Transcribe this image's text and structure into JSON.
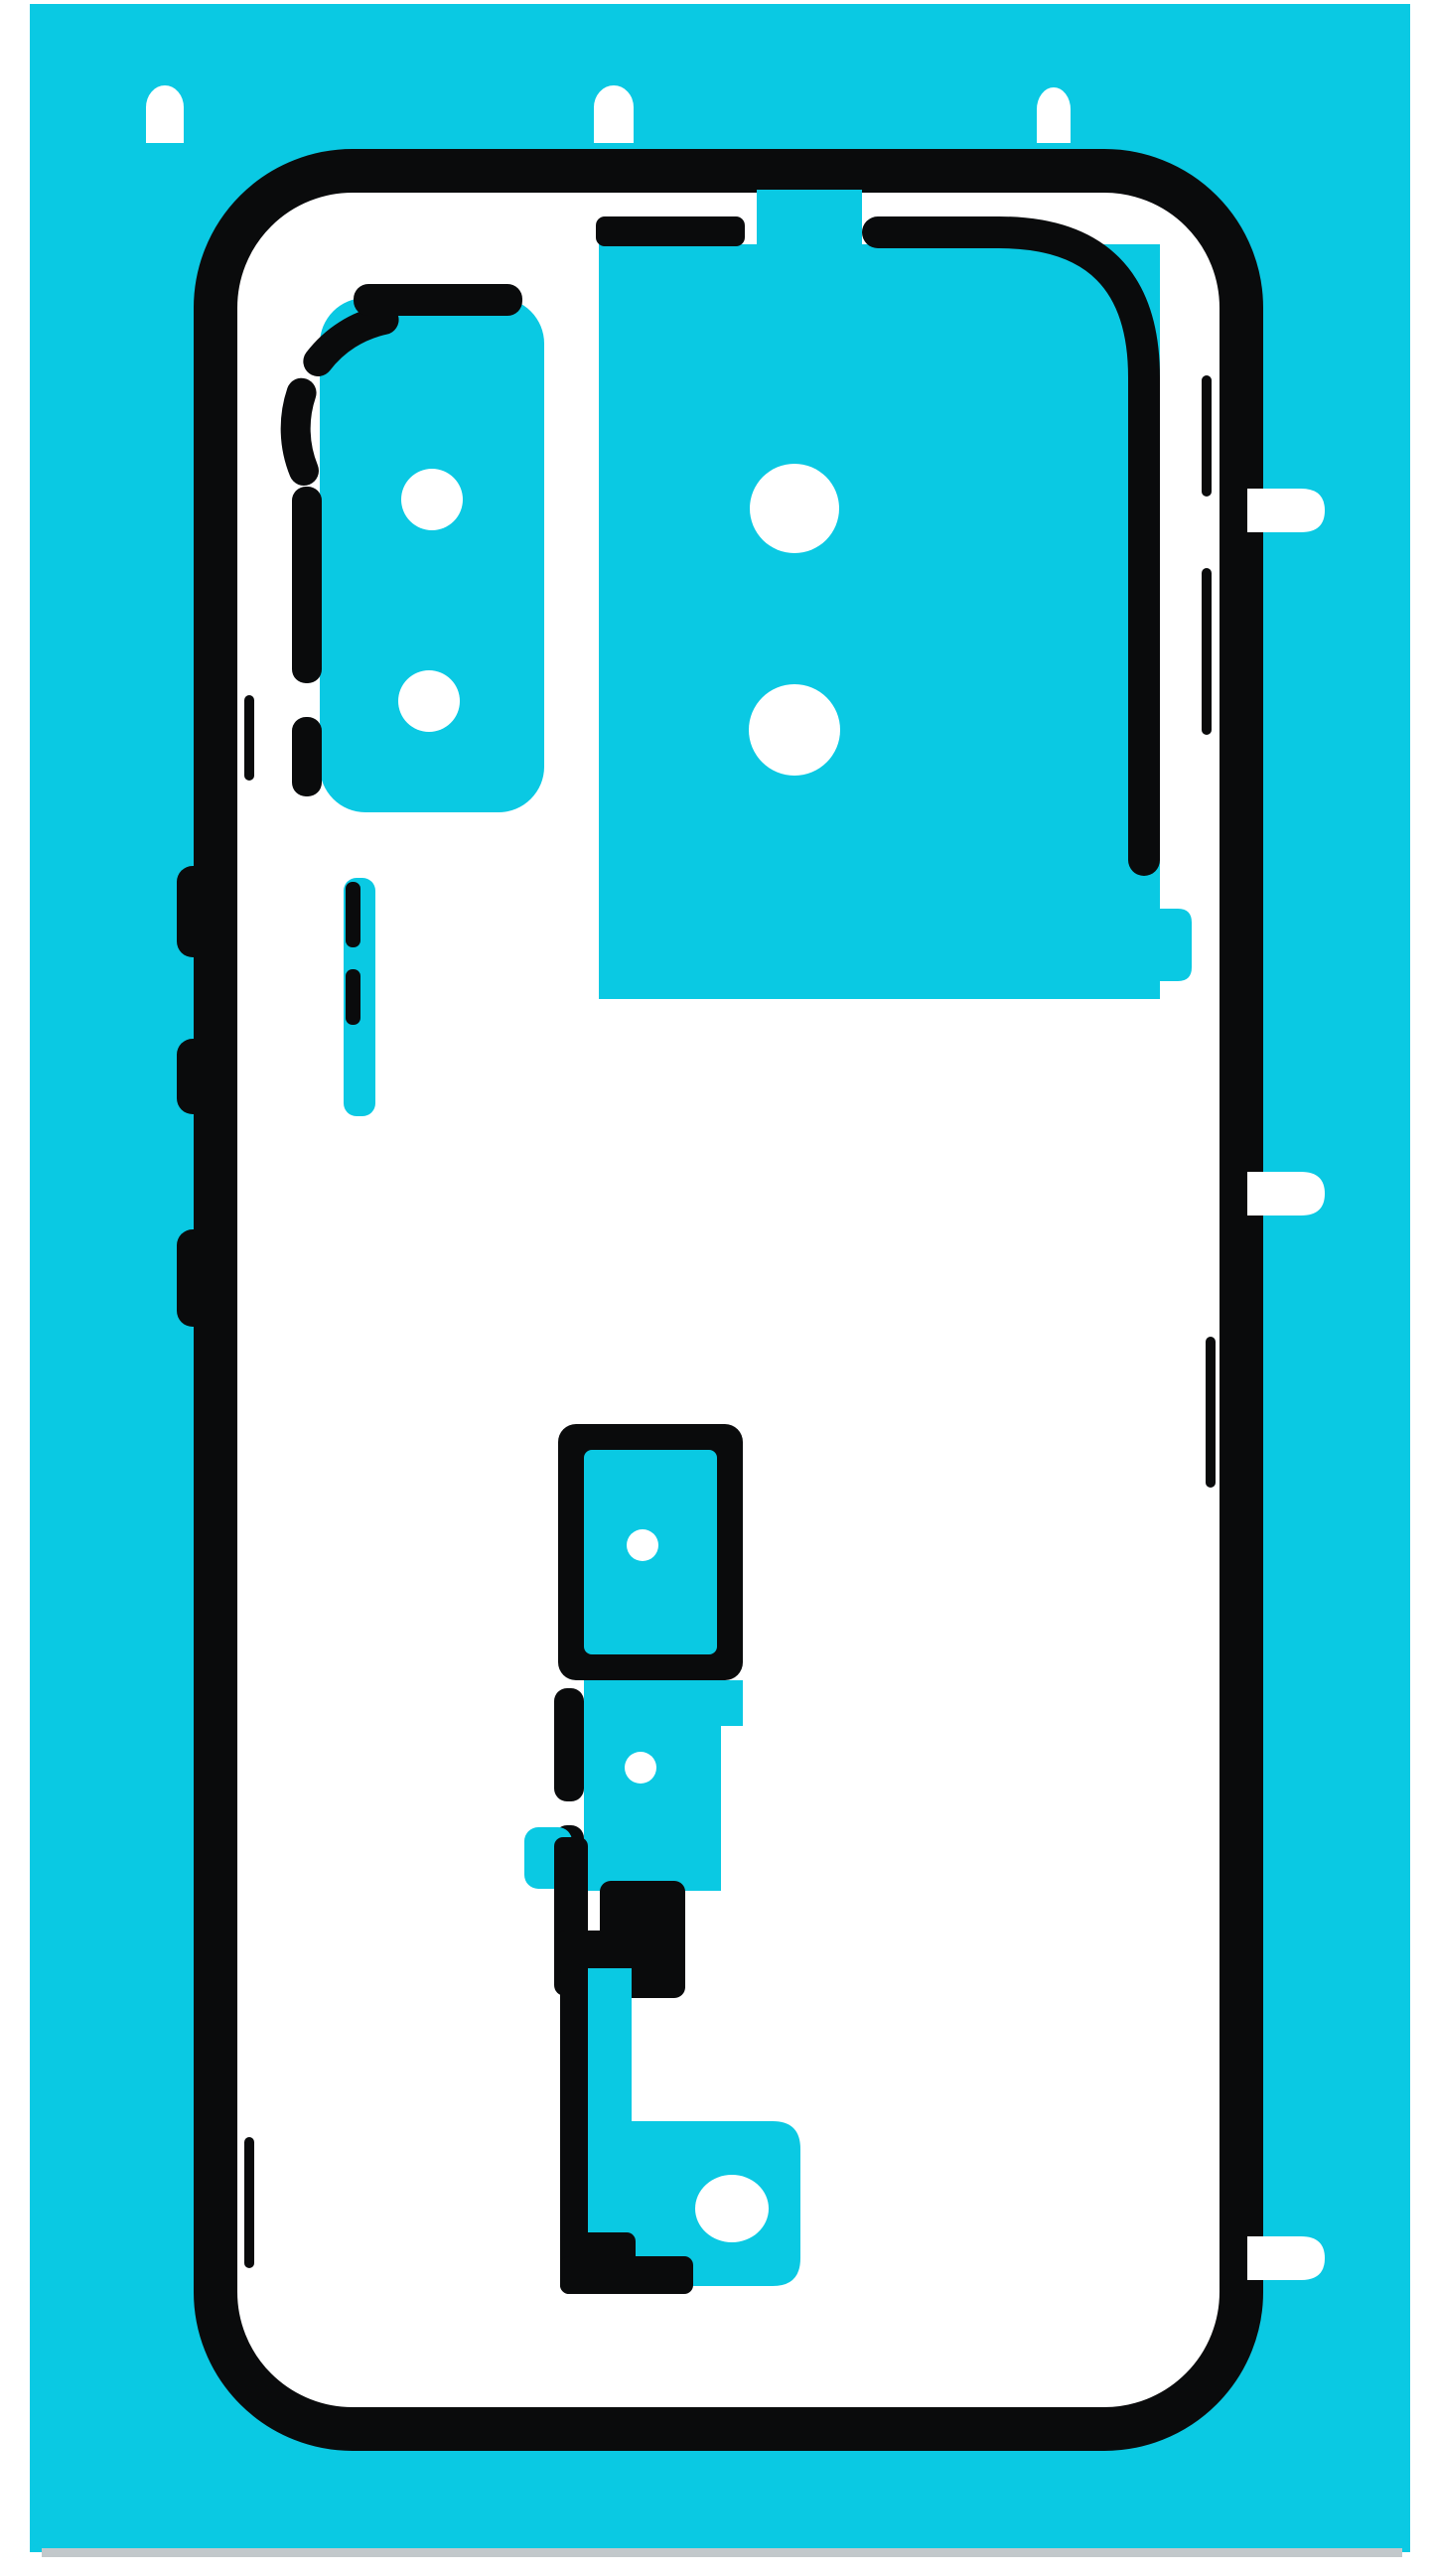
{
  "labels": {
    "figure": "Turquoise die-cut adhesive sticker sheet for a smartphone back cover (rear glass) replacement",
    "sheet": "Turquoise release liner",
    "gasket": "Perimeter back-cover adhesive gasket outline",
    "camera_left_pad": "Left camera-module adhesive pad with dashed cut border",
    "camera_main_pad": "Main camera-module adhesive pad",
    "button_strip": "Side-button adhesive strip",
    "lower_cluster": "Lower frame adhesive cluster",
    "top_tabs": "Top alignment tab cut-outs",
    "right_tabs": "Right-side pull tabs"
  },
  "colors": {
    "page_white": "#ffffff",
    "liner_cyan": "#0ac9e3",
    "cut_black": "#0a0b0c",
    "adhesive_white": "#ffffff",
    "photo_edge_gray": "#c2c8cb"
  },
  "counts": {
    "top_alignment_tabs": 3,
    "right_pull_tabs": 3,
    "left_camera_holes": 2,
    "main_camera_holes": 2,
    "lower_cluster_holes": 3,
    "button_strip_dashes": 2,
    "side_button_marks": 3
  }
}
